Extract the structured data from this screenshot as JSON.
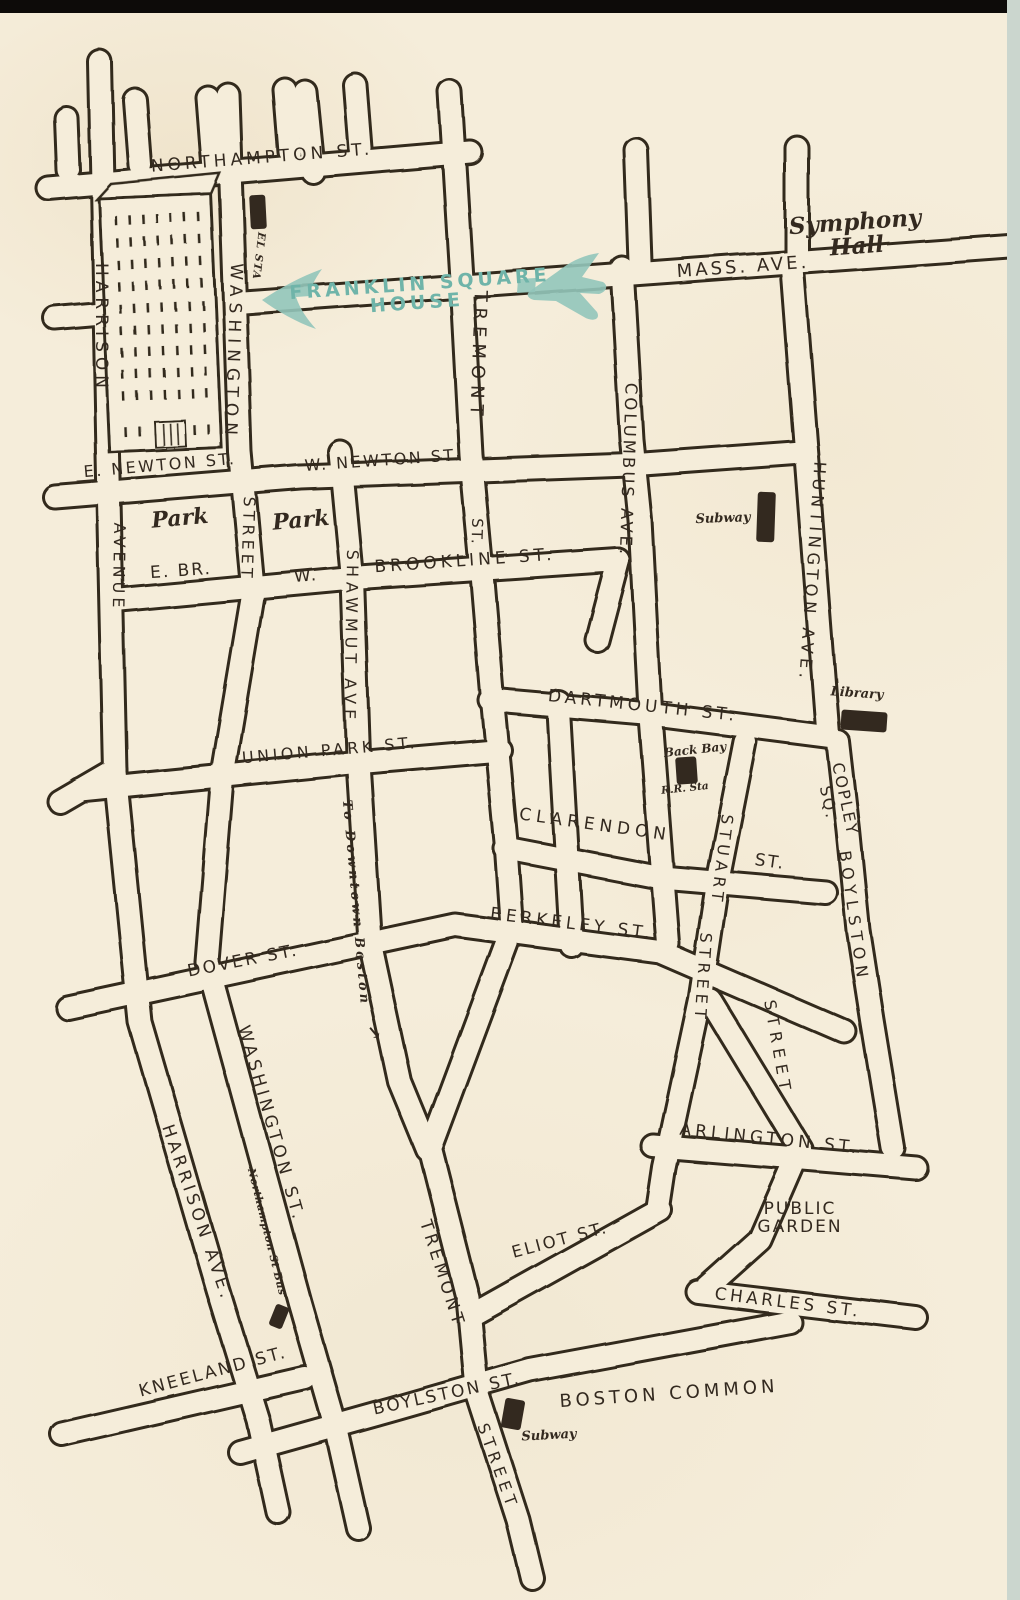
{
  "map": {
    "colors": {
      "paper": "#f5edda",
      "ink": "#33291f",
      "accent_teal": "#92c5ba",
      "accent_teal_text": "#6fb4a9",
      "scan_edge_top": "#0d0b09",
      "scan_edge_right": "#cbd6ce"
    },
    "highlight": {
      "line1": "FRANKLIN SQUARE",
      "line2": "HOUSE",
      "arrow_direction": "left"
    },
    "labels": [
      {
        "id": "northampton-st",
        "text": "NORTHAMPTON ST.",
        "x": 262,
        "y": 158,
        "rot": -4.5,
        "fs": 17,
        "ls": 4,
        "kind": "street"
      },
      {
        "id": "mass-ave",
        "text": "MASS. AVE.",
        "x": 743,
        "y": 267,
        "rot": -4,
        "fs": 18,
        "ls": 3,
        "kind": "street"
      },
      {
        "id": "harrison",
        "text": "HARRISON",
        "x": 101,
        "y": 328,
        "rot": 90,
        "fs": 17,
        "ls": 5,
        "kind": "street"
      },
      {
        "id": "washington",
        "text": "WASHINGTON",
        "x": 233,
        "y": 352,
        "rot": 92,
        "fs": 17,
        "ls": 6,
        "kind": "street"
      },
      {
        "id": "tremont",
        "text": "TREMONT",
        "x": 478,
        "y": 356,
        "rot": 92,
        "fs": 18,
        "ls": 6,
        "kind": "street"
      },
      {
        "id": "tremont-st",
        "text": "ST.",
        "x": 476,
        "y": 532,
        "rot": 92,
        "fs": 15,
        "ls": 2,
        "kind": "street"
      },
      {
        "id": "columbus-ave",
        "text": "COLUMBUS AVE.",
        "x": 628,
        "y": 470,
        "rot": 92,
        "fs": 16.5,
        "ls": 3,
        "kind": "street"
      },
      {
        "id": "huntington-ave",
        "text": "HUNTINGTON AVE.",
        "x": 812,
        "y": 572,
        "rot": 94,
        "fs": 16.5,
        "ls": 4.5,
        "kind": "street"
      },
      {
        "id": "e-newton-st",
        "text": "E. NEWTON ST.",
        "x": 160,
        "y": 466,
        "rot": -5,
        "fs": 16,
        "ls": 2.5,
        "kind": "street"
      },
      {
        "id": "w-newton-st",
        "text": "W. NEWTON ST.",
        "x": 383,
        "y": 461,
        "rot": -4,
        "fs": 16,
        "ls": 2.5,
        "kind": "street"
      },
      {
        "id": "avenue",
        "text": "AVENUE",
        "x": 118,
        "y": 567,
        "rot": 91,
        "fs": 16,
        "ls": 4,
        "kind": "street"
      },
      {
        "id": "street-washington",
        "text": "STREET",
        "x": 247,
        "y": 539,
        "rot": 92,
        "fs": 16,
        "ls": 4,
        "kind": "street"
      },
      {
        "id": "e-br",
        "text": "E. BR.",
        "x": 181,
        "y": 571,
        "rot": -4,
        "fs": 17,
        "ls": 2,
        "kind": "street"
      },
      {
        "id": "w",
        "text": "W.",
        "x": 306,
        "y": 576,
        "rot": -4,
        "fs": 17,
        "ls": 2,
        "kind": "street"
      },
      {
        "id": "brookline-st",
        "text": "BROOKLINE ST.",
        "x": 465,
        "y": 561,
        "rot": -4,
        "fs": 17,
        "ls": 4,
        "kind": "street"
      },
      {
        "id": "shawmut-ave",
        "text": "SHAWMUT AVE.",
        "x": 350,
        "y": 642,
        "rot": 91,
        "fs": 16,
        "ls": 5,
        "kind": "street"
      },
      {
        "id": "union-park-st",
        "text": "UNION PARK ST.",
        "x": 330,
        "y": 751,
        "rot": -5,
        "fs": 16,
        "ls": 3.5,
        "kind": "street"
      },
      {
        "id": "dartmouth-st",
        "text": "DARTMOUTH ST.",
        "x": 643,
        "y": 706,
        "rot": 6,
        "fs": 17,
        "ls": 4,
        "kind": "street"
      },
      {
        "id": "clarendon",
        "text": "CLARENDON",
        "x": 595,
        "y": 825,
        "rot": 8,
        "fs": 17,
        "ls": 5,
        "kind": "street"
      },
      {
        "id": "clarendon-st",
        "text": "ST.",
        "x": 770,
        "y": 862,
        "rot": 8,
        "fs": 17,
        "ls": 2,
        "kind": "street"
      },
      {
        "id": "stuart",
        "text": "STUART",
        "x": 721,
        "y": 860,
        "rot": 97,
        "fs": 16,
        "ls": 5,
        "kind": "street"
      },
      {
        "id": "street-stuart",
        "text": "STREET",
        "x": 702,
        "y": 978,
        "rot": 94,
        "fs": 16,
        "ls": 5,
        "kind": "street"
      },
      {
        "id": "copley-sq",
        "text": "COPLEY\nSQ.",
        "x": 836,
        "y": 801,
        "rot": 78,
        "fs": 16,
        "ls": 2,
        "kind": "street"
      },
      {
        "id": "boylston-diag",
        "text": "BOYLSTON",
        "x": 853,
        "y": 917,
        "rot": 82,
        "fs": 16,
        "ls": 6,
        "kind": "street"
      },
      {
        "id": "street-boylston",
        "text": "STREET",
        "x": 777,
        "y": 1048,
        "rot": 80,
        "fs": 16,
        "ls": 6,
        "kind": "street"
      },
      {
        "id": "berkeley-st",
        "text": "BERKELEY ST.",
        "x": 572,
        "y": 924,
        "rot": 7,
        "fs": 17,
        "ls": 4,
        "kind": "street"
      },
      {
        "id": "dover-st",
        "text": "DOVER ST.",
        "x": 243,
        "y": 961,
        "rot": -11,
        "fs": 17,
        "ls": 2.5,
        "kind": "street"
      },
      {
        "id": "washington-diag",
        "text": "WASHINGTON ST.",
        "x": 271,
        "y": 1124,
        "rot": 74,
        "fs": 17,
        "ls": 4,
        "kind": "street"
      },
      {
        "id": "harrison-ave",
        "text": "HARRISON AVE.",
        "x": 197,
        "y": 1213,
        "rot": 71,
        "fs": 17,
        "ls": 4,
        "kind": "street"
      },
      {
        "id": "kneeland-st",
        "text": "KNEELAND ST.",
        "x": 213,
        "y": 1372,
        "rot": -15,
        "fs": 17,
        "ls": 2.5,
        "kind": "street"
      },
      {
        "id": "tremont-diag",
        "text": "TREMONT",
        "x": 442,
        "y": 1274,
        "rot": 72,
        "fs": 17,
        "ls": 4,
        "kind": "street"
      },
      {
        "id": "eliot-st",
        "text": "ELIOT ST.",
        "x": 560,
        "y": 1240,
        "rot": -15,
        "fs": 16.5,
        "ls": 2.5,
        "kind": "street"
      },
      {
        "id": "arlington-st",
        "text": "ARLINGTON ST.",
        "x": 770,
        "y": 1139,
        "rot": 6,
        "fs": 17,
        "ls": 4,
        "kind": "street"
      },
      {
        "id": "charles-st",
        "text": "CHARLES ST.",
        "x": 788,
        "y": 1303,
        "rot": 7,
        "fs": 17,
        "ls": 3.5,
        "kind": "street"
      },
      {
        "id": "boylston-st-bottom",
        "text": "BOYLSTON ST.",
        "x": 447,
        "y": 1394,
        "rot": -12,
        "fs": 17,
        "ls": 2.5,
        "kind": "street"
      },
      {
        "id": "street-tremont-bottom",
        "text": "STREET",
        "x": 497,
        "y": 1467,
        "rot": 70,
        "fs": 16,
        "ls": 5,
        "kind": "street"
      },
      {
        "id": "boston-common",
        "text": "BOSTON COMMON",
        "x": 669,
        "y": 1394,
        "rot": -4,
        "fs": 18,
        "ls": 4,
        "kind": "street"
      },
      {
        "id": "public-garden",
        "text": "PUBLIC\nGARDEN",
        "x": 800,
        "y": 1218,
        "rot": 0,
        "fs": 17,
        "ls": 2,
        "kind": "street"
      },
      {
        "id": "symphony-hall",
        "text": "Symphony\nHall",
        "x": 856,
        "y": 235,
        "rot": -4,
        "fs": 23,
        "ls": 0,
        "kind": "script"
      },
      {
        "id": "park-west",
        "text": "Park",
        "x": 180,
        "y": 519,
        "rot": -5,
        "fs": 22,
        "ls": 0,
        "kind": "script"
      },
      {
        "id": "park-east",
        "text": "Park",
        "x": 301,
        "y": 521,
        "rot": -5,
        "fs": 22,
        "ls": 0,
        "kind": "script"
      },
      {
        "id": "subway-columbus",
        "text": "Subway",
        "x": 723,
        "y": 519,
        "rot": -2,
        "fs": 13,
        "ls": 0,
        "kind": "script"
      },
      {
        "id": "library",
        "text": "Library",
        "x": 857,
        "y": 694,
        "rot": 4,
        "fs": 13,
        "ls": 0,
        "kind": "script"
      },
      {
        "id": "back-bay",
        "text": "Back Bay",
        "x": 695,
        "y": 750,
        "rot": -6,
        "fs": 12,
        "ls": 0,
        "kind": "script"
      },
      {
        "id": "rr-sta",
        "text": "R.R. Sta",
        "x": 685,
        "y": 789,
        "rot": -6,
        "fs": 10.5,
        "ls": 0,
        "kind": "script"
      },
      {
        "id": "subway-common",
        "text": "Subway",
        "x": 549,
        "y": 1436,
        "rot": -3,
        "fs": 13,
        "ls": 0,
        "kind": "script"
      },
      {
        "id": "northampton-st-bus",
        "text": "Northampton St Bus",
        "x": 266,
        "y": 1232,
        "rot": 76,
        "fs": 10.5,
        "ls": 0.5,
        "kind": "script"
      },
      {
        "id": "el-sta",
        "text": "EL STA",
        "x": 258,
        "y": 256,
        "rot": 97,
        "fs": 10.5,
        "ls": 1,
        "kind": "script"
      },
      {
        "id": "to-downtown",
        "text": "To Downtown Boston",
        "x": 355,
        "y": 903,
        "rot": 85,
        "fs": 13,
        "ls": 3,
        "kind": "script"
      },
      {
        "id": "to-downtown-arrow",
        "text": "→",
        "x": 374,
        "y": 1033,
        "rot": 50,
        "fs": 18,
        "ls": 0,
        "kind": "script"
      }
    ],
    "markers": [
      {
        "id": "el-sta-station",
        "x": 258,
        "y": 212,
        "w": 16,
        "h": 34,
        "rot": -3
      },
      {
        "id": "subway-station-columbus",
        "x": 766,
        "y": 517,
        "w": 18,
        "h": 50,
        "rot": 2
      },
      {
        "id": "library-building",
        "x": 864,
        "y": 721,
        "w": 46,
        "h": 20,
        "rot": 4
      },
      {
        "id": "back-bay-rr-station",
        "x": 686,
        "y": 770,
        "w": 21,
        "h": 27,
        "rot": -4
      },
      {
        "id": "northampton-st-bus-stop",
        "x": 279,
        "y": 1316,
        "w": 14,
        "h": 23,
        "rot": 22
      },
      {
        "id": "subway-station-common",
        "x": 513,
        "y": 1414,
        "w": 20,
        "h": 30,
        "rot": 10
      }
    ]
  }
}
